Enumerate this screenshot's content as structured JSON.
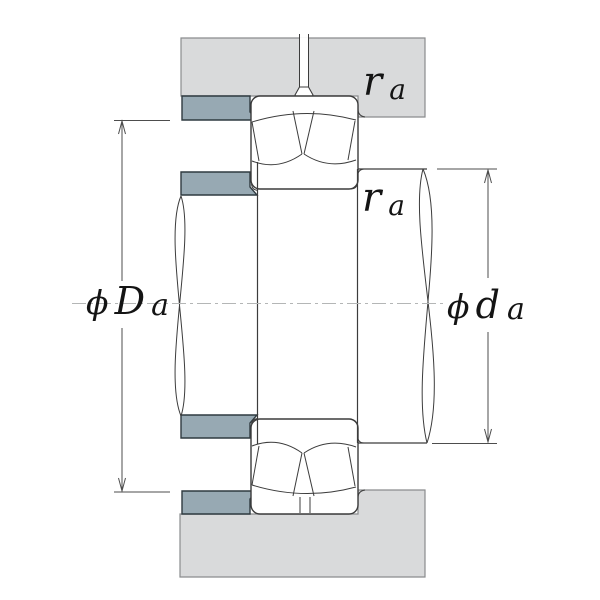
{
  "diagram": {
    "type": "bearing-mounting-abutment-cross-section",
    "labels": {
      "housing_shoulder_diameter": {
        "phi": "ϕ",
        "letter": "D",
        "sub": "a"
      },
      "shaft_shoulder_diameter": {
        "phi": "ϕ",
        "letter": "d",
        "sub": "a"
      },
      "fillet_radius_top": {
        "letter": "r",
        "sub": "a"
      },
      "fillet_radius_side": {
        "letter": "r",
        "sub": "a"
      }
    },
    "colors": {
      "background": "#ffffff",
      "housing_fill": "#d9dadb",
      "housing_edge": "#8a8c8e",
      "abutment_fill": "#97a9b3",
      "abutment_edge": "#2f3a40",
      "drawing_line": "#3c3c3c",
      "dimension_line": "#4d4d4d",
      "centerline": "#b4b6b6",
      "label_text": "#141414"
    }
  }
}
